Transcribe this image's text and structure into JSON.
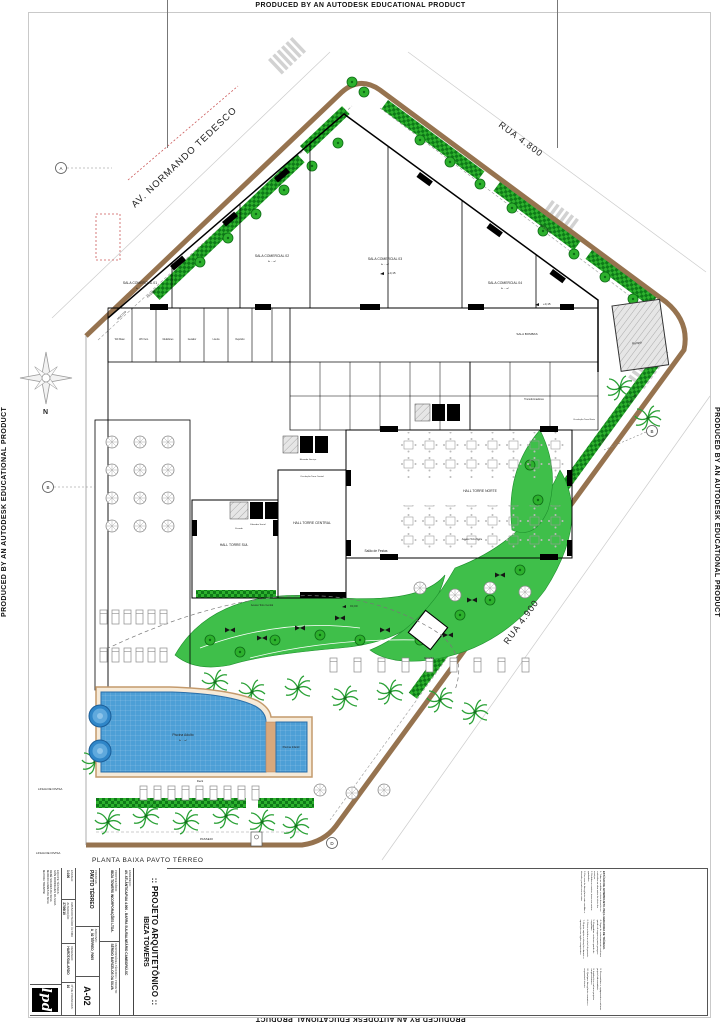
{
  "border_text": "PRODUCED BY AN AUTODESK EDUCATIONAL PRODUCT",
  "streets": {
    "avenue": "AV. NORMANDO TEDESCO",
    "street_top": "RUA  4.800",
    "street_bottom": "RUA  4.900"
  },
  "site": {
    "plan_title": "PLANTA BAIXA  PAVTO TÉRREO",
    "north_label": "N",
    "passeio": "PASSEIO",
    "meio_fio": "MEIO FIO",
    "linha_divisa_1": "LINHA DE DIVISA",
    "linha_divisa_2": "LINHA DE DIVISA"
  },
  "markers": {
    "a": "A",
    "b_left": "B",
    "b_right": "B",
    "d": "D"
  },
  "levels": {
    "l_015": "+0,15",
    "l_000": "±0,00"
  },
  "rooms": {
    "sala_comercial_01": "SALA COMERCIAL 01",
    "sala_comercial_02": "SALA COMERCIAL 02",
    "sala_comercial_03": "SALA COMERCIAL 03",
    "sala_comercial_04": "SALA COMERCIAL 04",
    "area_note": "A: ... m²",
    "sala_bombas": "SALA BOMBAS",
    "rampa": "Rampa",
    "guarita": "Guarita",
    "hall_torre_sul": "HALL TORRE SUL",
    "hall_torre_central": "HALL TORRE CENTRAL",
    "hall_torre_norte": "HALL TORRE NORTE",
    "salao_festas": "Salão de Festas",
    "elevador_social": "Elevador Social",
    "elevador_servico": "Elevador Serviço",
    "escada": "Escada",
    "circulacao_central": "Circulação Torre Central",
    "circulacao_norte": "Circulação Torre Norte",
    "acesso_central": "Acesso Torre Central",
    "acesso_norte": "Acesso Torre Norte",
    "transformadores": "Transformadores",
    "medidores": "Medidores",
    "gerador": "Gerador",
    "lixeira": "Lixeira",
    "deposito": "Depósito",
    "wc_masculino": "WC Masc.",
    "wc_feminino": "WC Fem.",
    "piscina_adulto": "Piscina Adulto",
    "piscina_infantil": "Piscina Infantil",
    "deck": "Deck"
  },
  "titleblock": {
    "title": ":: PROJETO ARQUITETÔNICO ::",
    "project": "IBIZA TOWERS",
    "endereco_label": "ENDEREÇO:",
    "endereco": "AV. ATLÂNTICA/RUA 4.900 - BARRA SUL/BALNEÁRIO CAMBORIÚ-SC",
    "proprietario_label": "PROPRIETÁRIO:",
    "proprietario": "IBIZA TOWERS INCORPORAÇÕES LTDA.",
    "responsavel_label": "RESPONSÁVEL TÉCNICO / PROJETO:",
    "responsavel": "SÉRGIO BARCELOS DA SILVA",
    "prancha_label": "PRANCHA:",
    "prancha": "PAVTO TÉRREO",
    "arquivo_label": "ARQUIVO:",
    "arquivo": "A_02 TÉRREO_R005",
    "escala_label": "ESCALA:",
    "escala": "1:100",
    "data_label": "DATA/CONTEÚDO ÚLTIMA ALTERAÇÃO:",
    "data": "27/09/10",
    "desenho_label": "DESENHO:",
    "desenho": "HARDT/GALARDO",
    "num_pranchas_label": "Nº DE PRANCHAS:",
    "num_pranchas": "10",
    "sheet_number": "A-02",
    "equipe_label": "EQUIPE TÉCNICA:",
    "equipe": [
      "IVAN RODRIGUES DA SILVA",
      "RENÉ SOARES DA SILVA",
      "MARCIO GOMES DA SILVA",
      "MAYARA TRENTINI"
    ],
    "logo_text": "lpd"
  },
  "notes": {
    "heading": "ESTÁGIO DE ANTEPROJETO. PEÇA GERADORA DE TRÁFEGO.",
    "items": [
      "1- Todas as medidas e níveis deverão ser conferidos na obra antes do início dos serviços.",
      "2- Medidas em metros, áreas em metros quadrados.",
      "3- Em caso de divergência entre medidas e desenho, prevalecem as cotas.",
      "4- Vagas de estacionamento conforme quadro de vagas no pavto garagem.",
      "5- Esquadrias conforme quadro de esquadrias.",
      "6- Níveis referidos ao nível do passeio.",
      "7- Projeto sujeito a alterações durante a aprovação nos órgãos competentes.",
      "8- Reservatórios e equipamentos conforme projeto hidrossanitário.",
      "9- Instalações conforme projetos complementares.",
      "10- Qualquer divergência comunicar o responsável técnico."
    ]
  }
}
